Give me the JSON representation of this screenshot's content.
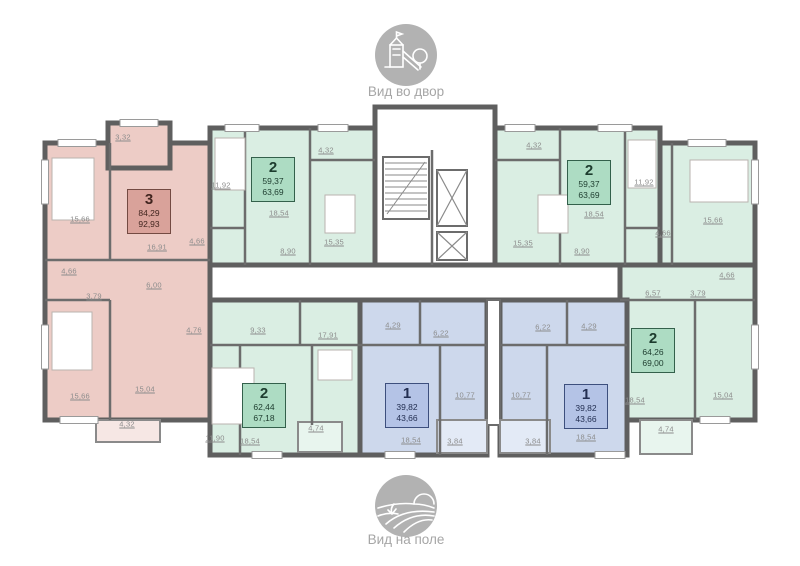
{
  "views": {
    "top": {
      "caption": "Вид во двор",
      "icon": "playground-icon"
    },
    "bottom": {
      "caption": "Вид на поле",
      "icon": "field-icon"
    }
  },
  "palette": {
    "wall": "#5f5f5f",
    "apartment_3_fill": "#edccc6",
    "apartment_3_badge": "#d9a29a",
    "apartment_3_border": "#734a42",
    "apartment_2_fill": "#daeee3",
    "apartment_2_badge": "#addcc3",
    "apartment_2_border": "#33604b",
    "apartment_1_fill": "#cdd8ec",
    "apartment_1_badge": "#b4c3e6",
    "apartment_1_border": "#3d4f7d",
    "room_label_text": "#8c8c8c",
    "caption_text": "#a6a6a6",
    "icon_gray": "#b2b2b2"
  },
  "apartments": [
    {
      "id": "apartment-3-left",
      "rooms": "3",
      "living_area": "84,29",
      "total_area": "92,93"
    },
    {
      "id": "apartment-2-top-left",
      "rooms": "2",
      "living_area": "59,37",
      "total_area": "63,69"
    },
    {
      "id": "apartment-2-top-right",
      "rooms": "2",
      "living_area": "59,37",
      "total_area": "63,69"
    },
    {
      "id": "apartment-2-right",
      "rooms": "2",
      "living_area": "64,26",
      "total_area": "69,00"
    },
    {
      "id": "apartment-2-bottom-left",
      "rooms": "2",
      "living_area": "62,44",
      "total_area": "67,18"
    },
    {
      "id": "apartment-1-bottom-left",
      "rooms": "1",
      "living_area": "39,82",
      "total_area": "43,66"
    },
    {
      "id": "apartment-1-bottom-right",
      "rooms": "1",
      "living_area": "39,82",
      "total_area": "43,66"
    }
  ],
  "room_labels": [
    {
      "apartment": "apartment-3-left",
      "text": "3,32"
    },
    {
      "apartment": "apartment-3-left",
      "text": "15,66"
    },
    {
      "apartment": "apartment-3-left",
      "text": "16,91"
    },
    {
      "apartment": "apartment-3-left",
      "text": "4,66"
    },
    {
      "apartment": "apartment-3-left",
      "text": "3,79"
    },
    {
      "apartment": "apartment-3-left",
      "text": "6,00"
    },
    {
      "apartment": "apartment-3-left",
      "text": "15,66"
    },
    {
      "apartment": "apartment-3-left",
      "text": "15,04"
    },
    {
      "apartment": "apartment-3-left",
      "text": "4,32"
    },
    {
      "apartment": "apartment-2-top-left",
      "text": "11,92"
    },
    {
      "apartment": "apartment-2-top-left",
      "text": "4,32"
    },
    {
      "apartment": "apartment-2-top-left",
      "text": "18,54"
    },
    {
      "apartment": "apartment-2-top-left",
      "text": "15,35"
    },
    {
      "apartment": "apartment-2-top-left",
      "text": "8,90"
    },
    {
      "apartment": "apartment-2-top-left",
      "text": "4,66"
    },
    {
      "apartment": "apartment-2-top-right",
      "text": "4,32"
    },
    {
      "apartment": "apartment-2-top-right",
      "text": "11,92"
    },
    {
      "apartment": "apartment-2-top-right",
      "text": "18,54"
    },
    {
      "apartment": "apartment-2-top-right",
      "text": "15,35"
    },
    {
      "apartment": "apartment-2-top-right",
      "text": "8,90"
    },
    {
      "apartment": "apartment-2-top-right",
      "text": "4,66"
    },
    {
      "apartment": "apartment-2-right",
      "text": "15,66"
    },
    {
      "apartment": "apartment-2-right",
      "text": "4,66"
    },
    {
      "apartment": "apartment-2-right",
      "text": "6,57"
    },
    {
      "apartment": "apartment-2-right",
      "text": "3,79"
    },
    {
      "apartment": "apartment-2-right",
      "text": "18,54"
    },
    {
      "apartment": "apartment-2-right",
      "text": "15,04"
    },
    {
      "apartment": "apartment-2-right",
      "text": "4,74"
    },
    {
      "apartment": "apartment-2-bottom-left",
      "text": "4,76"
    },
    {
      "apartment": "apartment-2-bottom-left",
      "text": "9,33"
    },
    {
      "apartment": "apartment-2-bottom-left",
      "text": "17,91"
    },
    {
      "apartment": "apartment-2-bottom-left",
      "text": "11,90"
    },
    {
      "apartment": "apartment-2-bottom-left",
      "text": "18,54"
    },
    {
      "apartment": "apartment-2-bottom-left",
      "text": "4,74"
    },
    {
      "apartment": "apartment-1-bottom-left",
      "text": "4,29"
    },
    {
      "apartment": "apartment-1-bottom-left",
      "text": "6,22"
    },
    {
      "apartment": "apartment-1-bottom-left",
      "text": "10,77"
    },
    {
      "apartment": "apartment-1-bottom-left",
      "text": "18,54"
    },
    {
      "apartment": "apartment-1-bottom-left",
      "text": "3,84"
    },
    {
      "apartment": "apartment-1-bottom-right",
      "text": "6,22"
    },
    {
      "apartment": "apartment-1-bottom-right",
      "text": "4,29"
    },
    {
      "apartment": "apartment-1-bottom-right",
      "text": "10,77"
    },
    {
      "apartment": "apartment-1-bottom-right",
      "text": "18,54"
    },
    {
      "apartment": "apartment-1-bottom-right",
      "text": "3,84"
    }
  ]
}
